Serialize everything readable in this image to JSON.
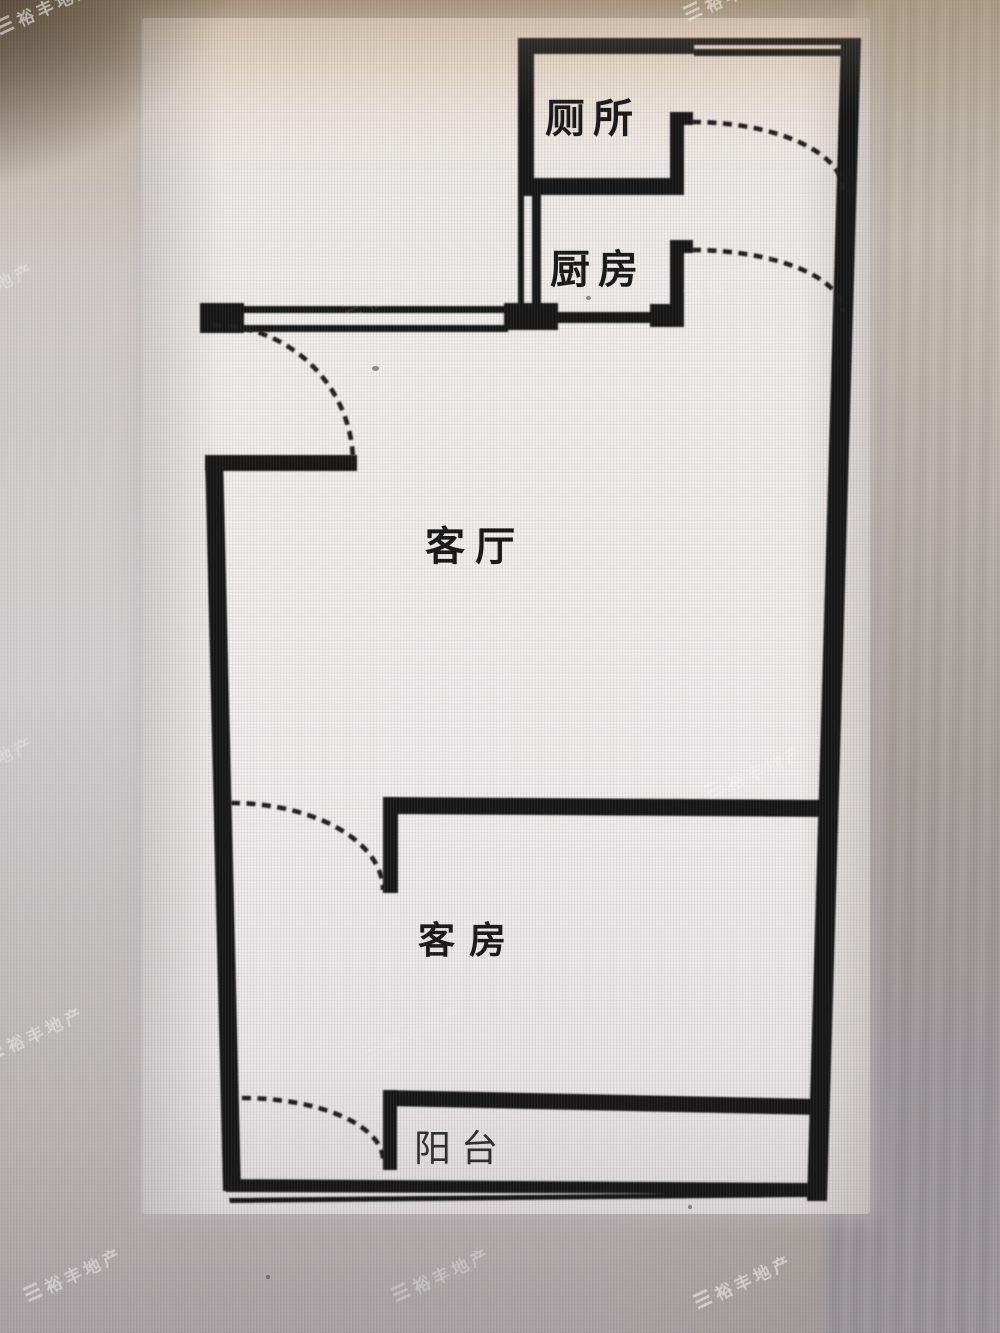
{
  "floorplan": {
    "rooms": [
      {
        "name": "toilet",
        "label": "厕所"
      },
      {
        "name": "kitchen",
        "label": "厨房"
      },
      {
        "name": "living_room",
        "label": "客厅"
      },
      {
        "name": "guest_room",
        "label": "客房"
      },
      {
        "name": "balcony",
        "label": "阳台"
      }
    ]
  },
  "watermark": {
    "logo": "☰",
    "brand": "裕丰地产"
  },
  "colors": {
    "wall": "#191919",
    "paper": "#f0eeee",
    "watermark": "#ffffff"
  }
}
